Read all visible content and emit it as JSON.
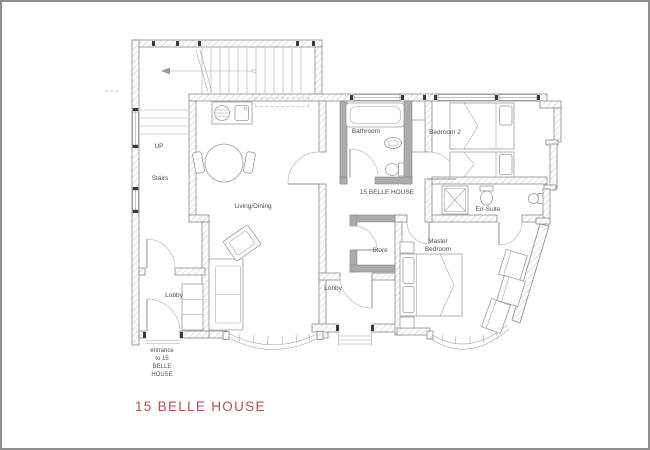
{
  "page": {
    "background": "#ffffff",
    "frame_color": "#8e8e8e"
  },
  "title": {
    "text": "15 BELLE HOUSE",
    "color": "#b5504c"
  },
  "plan": {
    "colors": {
      "wall_outline": "#8a8a8a",
      "wall_hatch": "#c9c9c9",
      "partition_fill": "#ababab",
      "furniture_line": "#9c9c9c",
      "label_text": "#4f4f4f"
    },
    "labels": {
      "up": "UP",
      "stairs": "Stairs",
      "living_dining": "Living/Dining",
      "bathroom": "Bathroom",
      "bedroom_2": "Bedroom 2",
      "hall": "15 BELLE HOUSE",
      "en_suite": "En-Suite",
      "store": "Store",
      "master_line1": "Master",
      "master_line2": "Bedroom",
      "lobby_main": "Lobby",
      "lobby_inner": "Lobby"
    },
    "entrance_note": {
      "line1": "entrance",
      "line2": "to 15",
      "line3": "BELLE",
      "line4": "HOUSE"
    }
  }
}
